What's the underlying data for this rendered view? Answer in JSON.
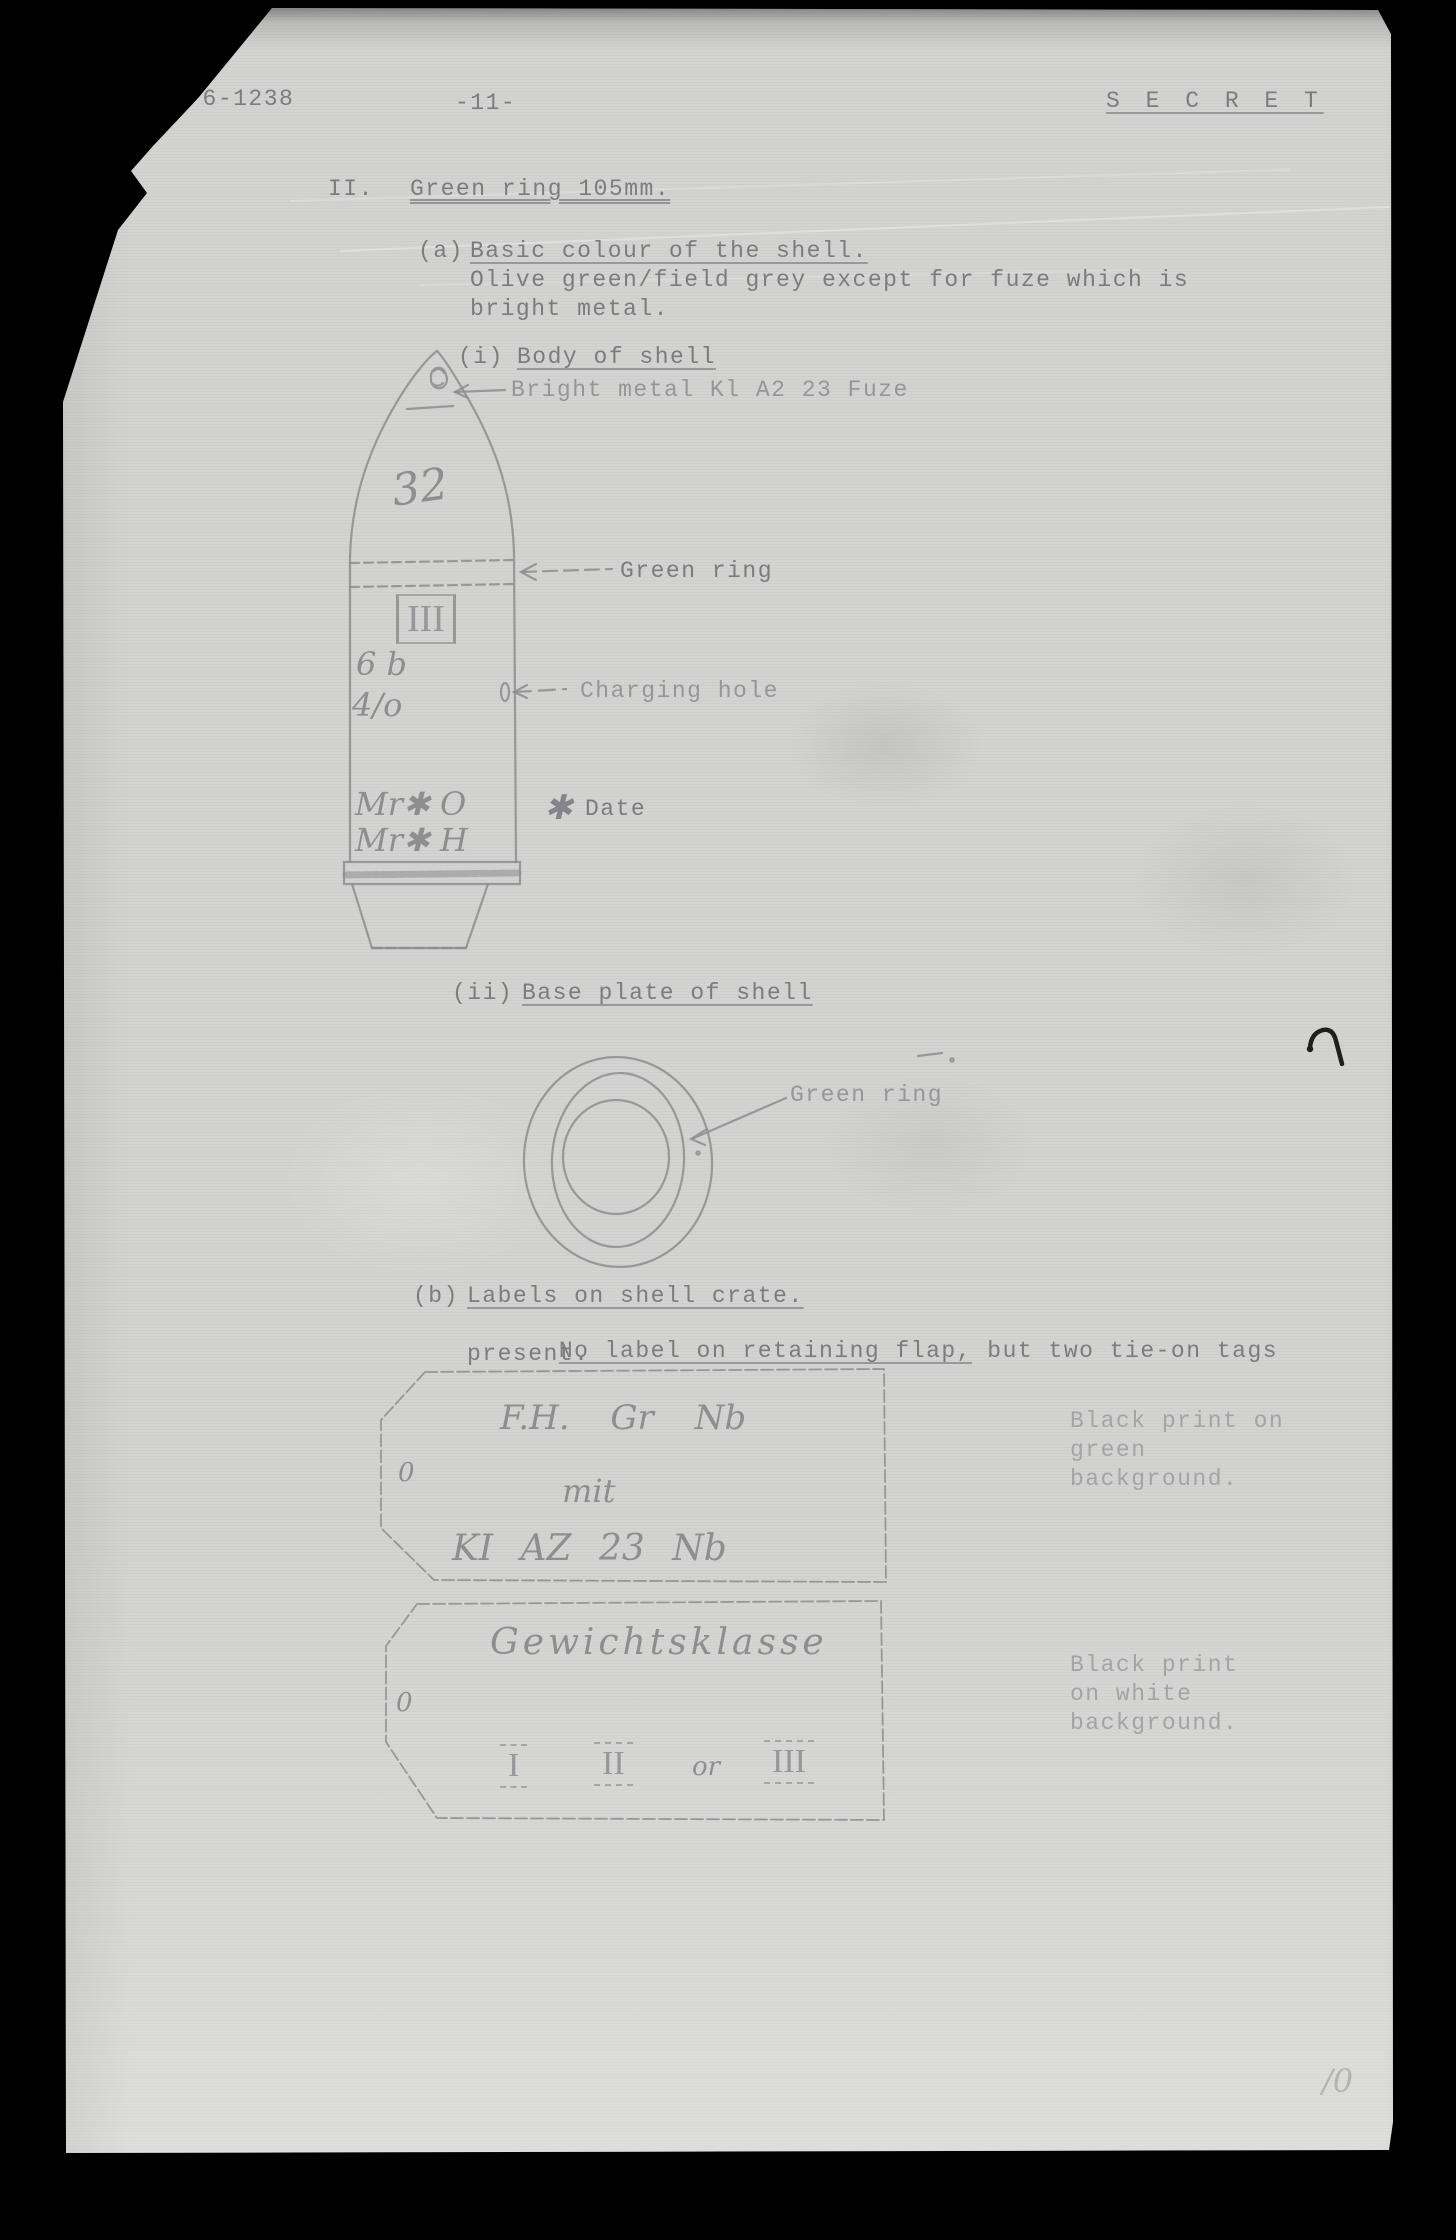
{
  "page": {
    "doc_ref": "D(W) 6-1238",
    "page_number": "-11-",
    "classification": "S E C R E T",
    "footer_mark": "/0"
  },
  "section": {
    "numeral": "II.",
    "title": "Green ring 105mm."
  },
  "item_a": {
    "label": "(a)",
    "heading": "Basic colour of the shell.",
    "body_line1": "Olive green/field grey except for fuze which is",
    "body_line2": "bright metal."
  },
  "item_i": {
    "label": "(i)",
    "heading": "Body of shell",
    "fuze_callout": "Bright metal Kl A2 23 Fuze"
  },
  "shell": {
    "nose_number": "32",
    "ring_label": "Green ring",
    "weight_class": "III",
    "mark_6b": "6 b",
    "mark_4o": "4/o",
    "charging_hole_label": "Charging hole",
    "mark_line1": "Mr✱ O",
    "mark_line2": "Mr✱ H",
    "date_star": "✱",
    "date_label": "Date"
  },
  "item_ii": {
    "label": "(ii)",
    "heading": "Base plate of shell",
    "ring_label": "Green ring"
  },
  "item_b": {
    "label": "(b)",
    "heading": "Labels on shell crate.",
    "line1_underlined": "No label on retaining flap,",
    "line1_rest": " but two tie-on tags",
    "line2": "present."
  },
  "tag1": {
    "hole": "0",
    "line1": "F.H. Gr Nb",
    "line2": "mit",
    "line3": "KI AZ 23 Nb",
    "note_line1": "Black print on",
    "note_line2": "green",
    "note_line3": "background."
  },
  "tag2": {
    "hole": "0",
    "title": "Gewichtsklasse",
    "numeral1": "I",
    "numeral2": "II",
    "conjunction": "or",
    "numeral3": "III",
    "note_line1": "Black print",
    "note_line2": "on white",
    "note_line3": "background."
  }
}
